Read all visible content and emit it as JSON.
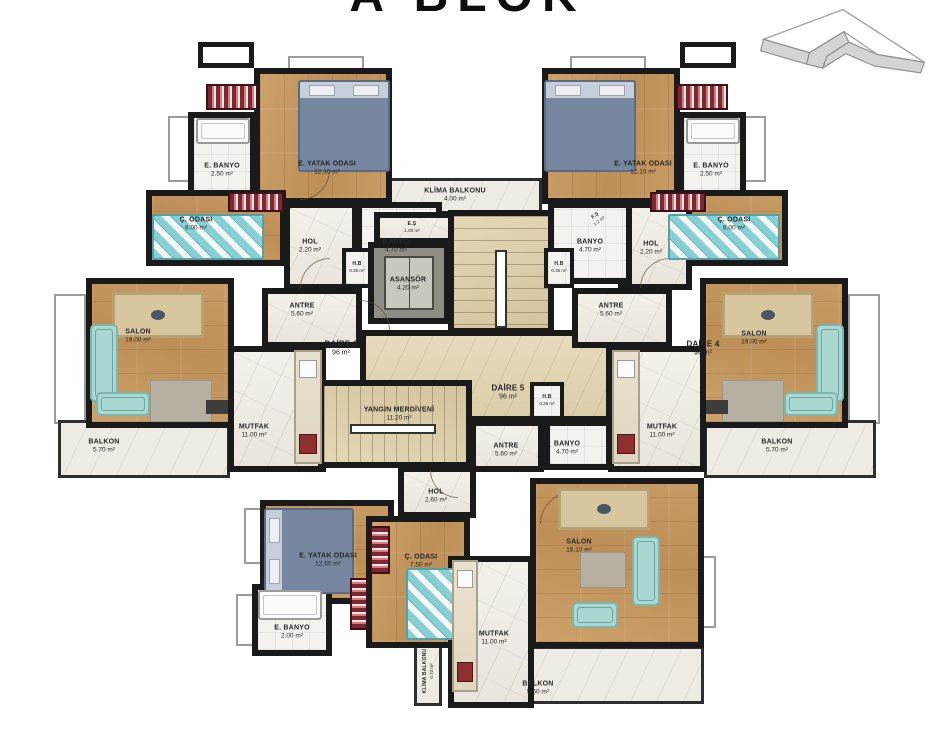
{
  "title": "A BLOK",
  "icons": {
    "compass": "north-arrow"
  },
  "colors": {
    "wall": "#1a1a1a",
    "wood": "#c49a63",
    "marble": "#f1eee8",
    "stair_core": "#ddcfab",
    "sofa_teal": "#a9d8d3",
    "bed_blue": "#76879f",
    "wardrobe_red": "#7d2733",
    "balcony": "#edebe4"
  },
  "plan": {
    "rooms": [
      {
        "id": "window-slab-left-side",
        "cls": "slab",
        "x": 54,
        "y": 294,
        "w": 32,
        "h": 130
      },
      {
        "id": "window-slab-right-side",
        "cls": "slab",
        "x": 848,
        "y": 294,
        "w": 32,
        "h": 130
      },
      {
        "id": "window-slab-ebanyo-left",
        "cls": "slab",
        "x": 168,
        "y": 116,
        "w": 22,
        "h": 66
      },
      {
        "id": "window-slab-ebanyo-right",
        "cls": "slab",
        "x": 744,
        "y": 116,
        "w": 22,
        "h": 66
      },
      {
        "id": "shaft-top-left",
        "cls": "shaft",
        "x": 198,
        "y": 42,
        "w": 56,
        "h": 26
      },
      {
        "id": "shaft-top-right",
        "cls": "shaft",
        "x": 680,
        "y": 42,
        "w": 56,
        "h": 26
      },
      {
        "id": "window-slab-top-left",
        "cls": "slab",
        "x": 288,
        "y": 56,
        "w": 76,
        "h": 16
      },
      {
        "id": "window-slab-top-right",
        "cls": "slab",
        "x": 570,
        "y": 56,
        "w": 76,
        "h": 16
      },
      {
        "id": "window-slab-bottom-left-1",
        "cls": "slab",
        "x": 244,
        "y": 508,
        "w": 18,
        "h": 56
      },
      {
        "id": "window-slab-bottom-left-2",
        "cls": "slab",
        "x": 236,
        "y": 594,
        "w": 18,
        "h": 52
      },
      {
        "id": "window-slab-salon-bottom",
        "cls": "slab",
        "x": 700,
        "y": 556,
        "w": 16,
        "h": 72
      },
      {
        "id": "balkon-left",
        "cls": "balcony",
        "x": 58,
        "y": 420,
        "w": 172,
        "h": 58
      },
      {
        "id": "balkon-right",
        "cls": "balcony",
        "x": 704,
        "y": 420,
        "w": 172,
        "h": 58
      },
      {
        "id": "balkon-bottom",
        "cls": "balcony",
        "x": 466,
        "y": 646,
        "w": 238,
        "h": 58
      },
      {
        "id": "klima-balkonu-top",
        "cls": "balcony",
        "x": 374,
        "y": 178,
        "w": 168,
        "h": 36
      },
      {
        "id": "klima-balkonu-bottom",
        "cls": "balcony",
        "x": 414,
        "y": 638,
        "w": 28,
        "h": 68
      },
      {
        "id": "core-lobby",
        "cls": "lobby",
        "x": 360,
        "y": 330,
        "w": 252,
        "h": 92
      },
      {
        "id": "eyatak-odasi-left",
        "cls": "wood-v",
        "x": 254,
        "y": 68,
        "w": 138,
        "h": 136
      },
      {
        "id": "ebanyo-left",
        "cls": "tile",
        "x": 188,
        "y": 112,
        "w": 68,
        "h": 100
      },
      {
        "id": "codasi-left",
        "cls": "wood-h",
        "x": 146,
        "y": 190,
        "w": 140,
        "h": 76
      },
      {
        "id": "hol-left",
        "cls": "marble",
        "x": 284,
        "y": 202,
        "w": 74,
        "h": 88
      },
      {
        "id": "banyo-left",
        "cls": "tile",
        "x": 356,
        "y": 202,
        "w": 86,
        "h": 82
      },
      {
        "id": "hb-left",
        "cls": "tile hb",
        "x": 342,
        "y": 248,
        "w": 30,
        "h": 40
      },
      {
        "id": "antre-left",
        "cls": "marble",
        "x": 262,
        "y": 288,
        "w": 100,
        "h": 60
      },
      {
        "id": "salon-left",
        "cls": "wood-h",
        "x": 86,
        "y": 278,
        "w": 148,
        "h": 150
      },
      {
        "id": "mutfak-left",
        "cls": "marble",
        "x": 228,
        "y": 346,
        "w": 98,
        "h": 126
      },
      {
        "id": "es-shaft-top",
        "cls": "marble",
        "x": 374,
        "y": 212,
        "w": 80,
        "h": 32
      },
      {
        "id": "stair-main",
        "cls": "stair-v",
        "x": 448,
        "y": 210,
        "w": 106,
        "h": 124
      },
      {
        "id": "asansor",
        "cls": "lift room",
        "x": 368,
        "y": 242,
        "w": 82,
        "h": 82
      },
      {
        "id": "hb-right",
        "cls": "tile hb",
        "x": 544,
        "y": 248,
        "w": 30,
        "h": 40
      },
      {
        "id": "yangin-merdiveni",
        "cls": "stair-h",
        "x": 318,
        "y": 380,
        "w": 154,
        "h": 88
      },
      {
        "id": "hb-bottom",
        "cls": "tile hb",
        "x": 530,
        "y": 382,
        "w": 34,
        "h": 38
      },
      {
        "id": "antre-bottom",
        "cls": "marble",
        "x": 470,
        "y": 420,
        "w": 74,
        "h": 52
      },
      {
        "id": "banyo-bottom",
        "cls": "tile",
        "x": 544,
        "y": 420,
        "w": 68,
        "h": 50
      },
      {
        "id": "hol-bottom",
        "cls": "marble",
        "x": 398,
        "y": 466,
        "w": 78,
        "h": 52
      },
      {
        "id": "eyatak-odasi-right",
        "cls": "wood-v",
        "x": 542,
        "y": 68,
        "w": 138,
        "h": 136
      },
      {
        "id": "ebanyo-right",
        "cls": "tile",
        "x": 678,
        "y": 112,
        "w": 68,
        "h": 100
      },
      {
        "id": "codasi-right",
        "cls": "wood-h",
        "x": 656,
        "y": 190,
        "w": 132,
        "h": 76
      },
      {
        "id": "hol-right",
        "cls": "marble",
        "x": 618,
        "y": 202,
        "w": 74,
        "h": 88
      },
      {
        "id": "banyo-right",
        "cls": "tile",
        "x": 548,
        "y": 202,
        "w": 84,
        "h": 82
      },
      {
        "id": "antre-right",
        "cls": "marble",
        "x": 572,
        "y": 288,
        "w": 100,
        "h": 60
      },
      {
        "id": "salon-right",
        "cls": "wood-h",
        "x": 700,
        "y": 278,
        "w": 148,
        "h": 150
      },
      {
        "id": "mutfak-right",
        "cls": "marble",
        "x": 608,
        "y": 346,
        "w": 98,
        "h": 126
      },
      {
        "id": "eyatak-odasi-bottom",
        "cls": "wood-h",
        "x": 260,
        "y": 500,
        "w": 134,
        "h": 104
      },
      {
        "id": "codasi-bottom",
        "cls": "wood-v",
        "x": 366,
        "y": 516,
        "w": 104,
        "h": 132
      },
      {
        "id": "ebanyo-bottom",
        "cls": "tile",
        "x": 252,
        "y": 584,
        "w": 80,
        "h": 72
      },
      {
        "id": "mutfak-bottom",
        "cls": "marble",
        "x": 448,
        "y": 556,
        "w": 86,
        "h": 152
      },
      {
        "id": "salon-bottom",
        "cls": "wood-h",
        "x": 530,
        "y": 478,
        "w": 174,
        "h": 170
      }
    ],
    "furniture": [
      {
        "id": "double-bed",
        "cls": "bed",
        "x": 298,
        "y": 80,
        "w": 92,
        "h": 92
      },
      {
        "id": "double-bed",
        "cls": "bed",
        "x": 544,
        "y": 80,
        "w": 92,
        "h": 92
      },
      {
        "id": "double-bed",
        "cls": "bed rot270",
        "x": 266,
        "y": 506,
        "w": 86,
        "h": 90
      },
      {
        "id": "kids-bed",
        "cls": "kidsbed",
        "x": 152,
        "y": 214,
        "w": 112,
        "h": 46
      },
      {
        "id": "kids-bed",
        "cls": "kidsbed",
        "x": 668,
        "y": 214,
        "w": 112,
        "h": 46
      },
      {
        "id": "kids-bed",
        "cls": "kidsbed",
        "x": 406,
        "y": 568,
        "w": 58,
        "h": 72
      },
      {
        "id": "wardrobe",
        "cls": "wr-h",
        "x": 206,
        "y": 84,
        "w": 52,
        "h": 26
      },
      {
        "id": "wardrobe",
        "cls": "wr-h",
        "x": 676,
        "y": 84,
        "w": 52,
        "h": 26
      },
      {
        "id": "wardrobe",
        "cls": "wr-h",
        "x": 228,
        "y": 192,
        "w": 56,
        "h": 20
      },
      {
        "id": "wardrobe",
        "cls": "wr-h",
        "x": 650,
        "y": 192,
        "w": 56,
        "h": 20
      },
      {
        "id": "wardrobe",
        "cls": "wr-v",
        "x": 370,
        "y": 526,
        "w": 20,
        "h": 48
      },
      {
        "id": "wardrobe",
        "cls": "wr-v",
        "x": 350,
        "y": 578,
        "w": 18,
        "h": 52
      },
      {
        "id": "dining-table",
        "cls": "table",
        "x": 112,
        "y": 292,
        "w": 92,
        "h": 46
      },
      {
        "id": "dining-table",
        "cls": "table",
        "x": 722,
        "y": 292,
        "w": 92,
        "h": 46
      },
      {
        "id": "dining-table",
        "cls": "table",
        "x": 558,
        "y": 488,
        "w": 92,
        "h": 42
      },
      {
        "id": "sofa",
        "cls": "sofa",
        "x": 90,
        "y": 324,
        "w": 28,
        "h": 78
      },
      {
        "id": "sofa",
        "cls": "sofa",
        "x": 96,
        "y": 392,
        "w": 54,
        "h": 24
      },
      {
        "id": "sofa",
        "cls": "sofa",
        "x": 816,
        "y": 324,
        "w": 28,
        "h": 78
      },
      {
        "id": "sofa",
        "cls": "sofa",
        "x": 784,
        "y": 392,
        "w": 54,
        "h": 24
      },
      {
        "id": "sofa",
        "cls": "sofa",
        "x": 632,
        "y": 536,
        "w": 28,
        "h": 70
      },
      {
        "id": "sofa",
        "cls": "sofa",
        "x": 572,
        "y": 602,
        "w": 46,
        "h": 26
      },
      {
        "id": "rug",
        "cls": "rug",
        "x": 150,
        "y": 380,
        "w": 62,
        "h": 42
      },
      {
        "id": "rug",
        "cls": "rug",
        "x": 722,
        "y": 380,
        "w": 62,
        "h": 42
      },
      {
        "id": "rug",
        "cls": "rug",
        "x": 580,
        "y": 552,
        "w": 46,
        "h": 36
      },
      {
        "id": "tv-unit",
        "cls": "tvunit",
        "x": 206,
        "y": 400,
        "w": 22,
        "h": 14
      },
      {
        "id": "tv-unit",
        "cls": "tvunit",
        "x": 706,
        "y": 400,
        "w": 22,
        "h": 14
      },
      {
        "id": "kitchen-counter",
        "cls": "counter-v",
        "x": 294,
        "y": 350,
        "w": 28,
        "h": 114
      },
      {
        "id": "kitchen-counter",
        "cls": "counter-v",
        "x": 612,
        "y": 350,
        "w": 28,
        "h": 114
      },
      {
        "id": "kitchen-counter",
        "cls": "counter-v",
        "x": 452,
        "y": 560,
        "w": 26,
        "h": 132
      },
      {
        "id": "shower-tub",
        "cls": "tub",
        "x": 196,
        "y": 118,
        "w": 54,
        "h": 26
      },
      {
        "id": "shower-tub",
        "cls": "tub",
        "x": 686,
        "y": 118,
        "w": 54,
        "h": 26
      },
      {
        "id": "shower-tub",
        "cls": "tub",
        "x": 258,
        "y": 590,
        "w": 64,
        "h": 30
      },
      {
        "id": "elevator-car",
        "cls": "liftcar",
        "x": 384,
        "y": 256,
        "w": 50,
        "h": 54
      },
      {
        "id": "stair-handrail",
        "cls": "rail",
        "x": 495,
        "y": 250,
        "w": 12,
        "h": 78
      },
      {
        "id": "stair-handrail",
        "cls": "rail",
        "x": 350,
        "y": 424,
        "w": 86,
        "h": 10
      },
      {
        "id": "door-arc",
        "cls": "arc",
        "x": 300,
        "y": 258,
        "w": 30,
        "h": 30
      },
      {
        "id": "door-arc",
        "cls": "arc rot90",
        "x": 360,
        "y": 300,
        "w": 30,
        "h": 30
      },
      {
        "id": "door-arc",
        "cls": "arc",
        "x": 640,
        "y": 258,
        "w": 30,
        "h": 30
      },
      {
        "id": "door-arc",
        "cls": "arc rot180",
        "x": 300,
        "y": 170,
        "w": 30,
        "h": 30
      },
      {
        "id": "door-arc",
        "cls": "arc rot270",
        "x": 430,
        "y": 470,
        "w": 28,
        "h": 28
      },
      {
        "id": "door-arc",
        "cls": "arc",
        "x": 540,
        "y": 492,
        "w": 32,
        "h": 32
      }
    ],
    "labels": [
      {
        "text": "E. BANYO",
        "sub": "2.50 m²",
        "x": 222,
        "y": 170
      },
      {
        "text": "E. YATAK ODASI",
        "sub": "12.10 m²",
        "x": 327,
        "y": 168
      },
      {
        "text": "Ç. ODASI",
        "sub": "8.00 m²",
        "x": 196,
        "y": 224
      },
      {
        "text": "HOL",
        "sub": "2.20 m²",
        "x": 310,
        "y": 246
      },
      {
        "text": "BANYO",
        "sub": "4.70 m²",
        "x": 396,
        "y": 246
      },
      {
        "text": "H.B",
        "sub": "0.35 m²",
        "x": 357,
        "y": 267,
        "cls": "tiny"
      },
      {
        "text": "ANTRE",
        "sub": "5.60 m²",
        "x": 302,
        "y": 310
      },
      {
        "text": "SALON",
        "sub": "19.00 m²",
        "x": 138,
        "y": 336
      },
      {
        "text": "MUTFAK",
        "sub": "11.00 m²",
        "x": 254,
        "y": 431
      },
      {
        "text": "BALKON",
        "sub": "5.70 m²",
        "x": 104,
        "y": 446
      },
      {
        "text": "DAİRE 6",
        "sub": "96 m²",
        "x": 341,
        "y": 349,
        "cls": "daire",
        "id": "apartment-label"
      },
      {
        "text": "KLİMA BALKONU",
        "sub": "4.00 m²",
        "x": 455,
        "y": 195
      },
      {
        "text": "E.Ş",
        "sub": "1.00 m²",
        "x": 412,
        "y": 227,
        "cls": "tiny"
      },
      {
        "text": "F.Ş",
        "sub": "1.2 m²",
        "x": 597,
        "y": 218,
        "cls": "tiny",
        "rot": -38
      },
      {
        "text": "ASANSÖR",
        "sub": "4.20 m²",
        "x": 408,
        "y": 284
      },
      {
        "text": "H.B",
        "sub": "0.35 m²",
        "x": 559,
        "y": 267,
        "cls": "tiny"
      },
      {
        "text": "DAİRE 5",
        "sub": "96 m²",
        "x": 508,
        "y": 393,
        "cls": "daire",
        "id": "apartment-label"
      },
      {
        "text": "DAİRE 4",
        "sub": "96 m²",
        "x": 703,
        "y": 349,
        "cls": "daire",
        "id": "apartment-label"
      },
      {
        "text": "H.B",
        "sub": "0.35 m²",
        "x": 547,
        "y": 400,
        "cls": "tiny"
      },
      {
        "text": "YANGIN MERDİVENİ",
        "sub": "11.20 m²",
        "x": 399,
        "y": 414
      },
      {
        "text": "ANTRE",
        "sub": "5.60 m²",
        "x": 506,
        "y": 450
      },
      {
        "text": "BANYO",
        "sub": "4.70 m²",
        "x": 567,
        "y": 448
      },
      {
        "text": "HOL",
        "sub": "2.60 m²",
        "x": 436,
        "y": 496
      },
      {
        "text": "E. YATAK ODASI",
        "sub": "12.60 m²",
        "x": 328,
        "y": 560
      },
      {
        "text": "Ç. ODASI",
        "sub": "7.50 m²",
        "x": 421,
        "y": 561
      },
      {
        "text": "E. BANYO",
        "sub": "2.00 m²",
        "x": 292,
        "y": 632
      },
      {
        "text": "KLİMA BALKONU",
        "sub": "0.73 m²",
        "x": 428,
        "y": 671,
        "cls": "tiny",
        "rot": -90
      },
      {
        "text": "MUTFAK",
        "sub": "11.00 m²",
        "x": 494,
        "y": 638
      },
      {
        "text": "SALON",
        "sub": "18.10 m²",
        "x": 579,
        "y": 546
      },
      {
        "text": "BALKON",
        "sub": "5.50 m²",
        "x": 538,
        "y": 688
      },
      {
        "text": "E. YATAK ODASI",
        "sub": "12.10 m²",
        "x": 643,
        "y": 168
      },
      {
        "text": "E. BANYO",
        "sub": "2.50 m²",
        "x": 711,
        "y": 170
      },
      {
        "text": "Ç. ODASI",
        "sub": "8.00 m²",
        "x": 734,
        "y": 224
      },
      {
        "text": "HOL",
        "sub": "2.20 m²",
        "x": 651,
        "y": 248
      },
      {
        "text": "BANYO",
        "sub": "4.70 m²",
        "x": 590,
        "y": 246
      },
      {
        "text": "ANTRE",
        "sub": "5.60 m²",
        "x": 611,
        "y": 310
      },
      {
        "text": "SALON",
        "sub": "19.00 m²",
        "x": 754,
        "y": 338
      },
      {
        "text": "MUTFAK",
        "sub": "11.00 m²",
        "x": 662,
        "y": 431
      },
      {
        "text": "BALKON",
        "sub": "5.70 m²",
        "x": 777,
        "y": 446
      }
    ]
  }
}
